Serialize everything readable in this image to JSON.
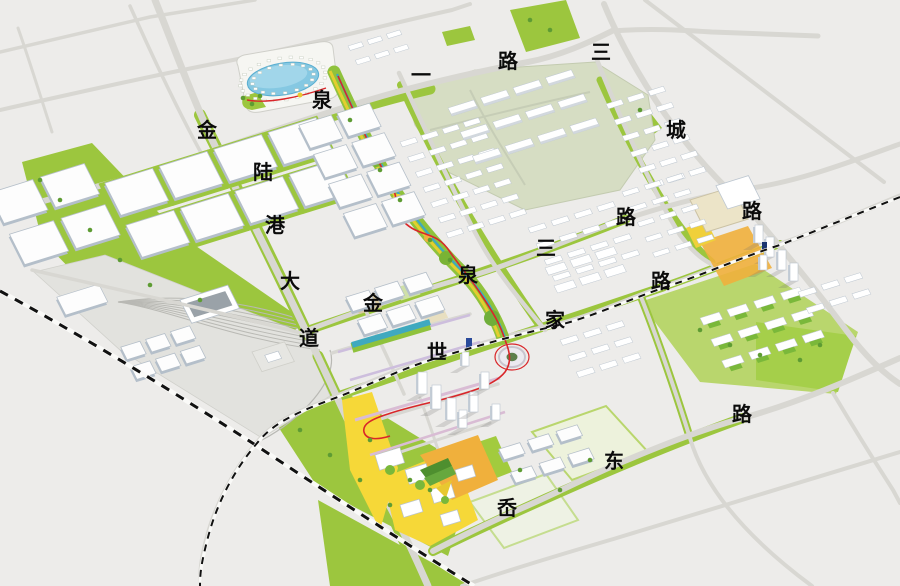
{
  "map": {
    "labels": [
      {
        "text": "金",
        "x": 207,
        "y": 131
      },
      {
        "text": "陆",
        "x": 263,
        "y": 173
      },
      {
        "text": "港",
        "x": 275,
        "y": 226
      },
      {
        "text": "大",
        "x": 290,
        "y": 282
      },
      {
        "text": "道",
        "x": 309,
        "y": 339
      },
      {
        "text": "泉",
        "x": 322,
        "y": 101
      },
      {
        "text": "一",
        "x": 421,
        "y": 76
      },
      {
        "text": "路",
        "x": 508,
        "y": 62
      },
      {
        "text": "三",
        "x": 601,
        "y": 53
      },
      {
        "text": "城",
        "x": 676,
        "y": 131
      },
      {
        "text": "路",
        "x": 752,
        "y": 212
      },
      {
        "text": "泉",
        "x": 468,
        "y": 276
      },
      {
        "text": "三",
        "x": 546,
        "y": 249
      },
      {
        "text": "路",
        "x": 626,
        "y": 218
      },
      {
        "text": "金",
        "x": 373,
        "y": 304
      },
      {
        "text": "世",
        "x": 437,
        "y": 353
      },
      {
        "text": "家",
        "x": 555,
        "y": 321
      },
      {
        "text": "路",
        "x": 661,
        "y": 282
      },
      {
        "text": "岙",
        "x": 507,
        "y": 509
      },
      {
        "text": "东",
        "x": 614,
        "y": 462
      },
      {
        "text": "路",
        "x": 742,
        "y": 415
      }
    ],
    "road_names": [
      "金陆港大道",
      "泉一路",
      "三城路",
      "泉三路",
      "世家路",
      "岙东路"
    ],
    "colors": {
      "background": "#edecea",
      "road": "#d8d7d2",
      "green": "#9cc63e",
      "green_dark": "#5e9c33",
      "pale_industrial": "#d6ddc3",
      "lake_blue": "#85c8e2",
      "cbd_yellow": "#f6d838",
      "cbd_orange": "#f0b03c",
      "greenway_red": "#d9262a",
      "railway_black": "#111111"
    }
  }
}
